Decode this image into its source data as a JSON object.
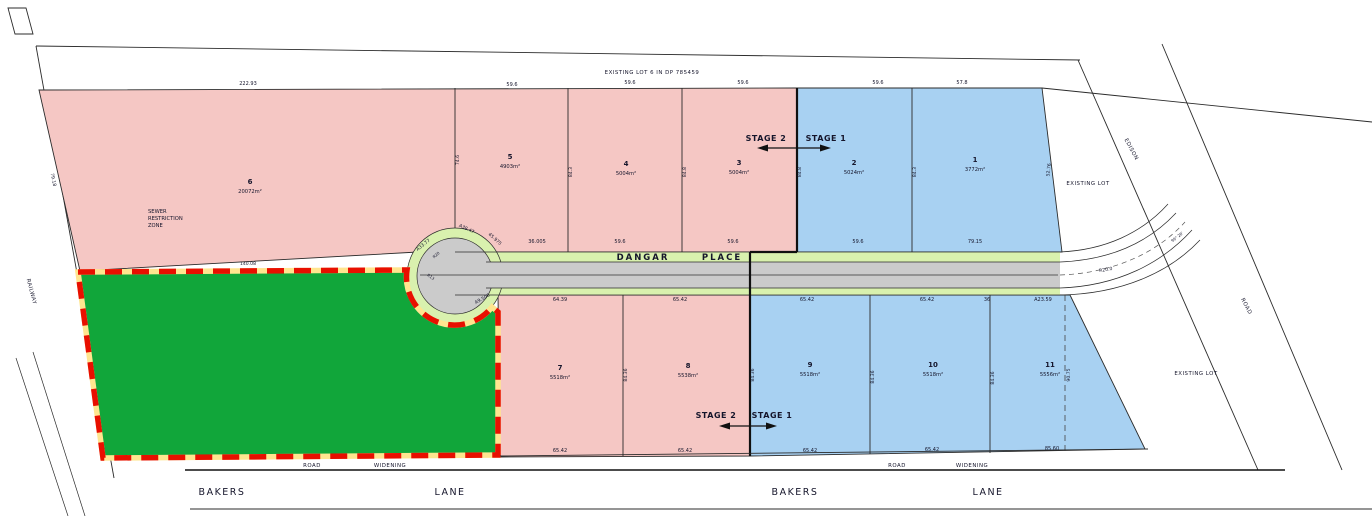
{
  "colors": {
    "pink": "#f5c7c4",
    "blue": "#a8d1f2",
    "green": "#11a63a",
    "verge": "#d9f1ae",
    "pavement": "#cbcbcb",
    "dash_red": "#e80f00",
    "dash_under": "#ffe58f"
  },
  "header": {
    "existing_lot_ref": "EXISTING LOT 6 IN DP 785459"
  },
  "corridors": {
    "railway": "RAILWAY",
    "edison": "EDISON",
    "edison_road": "ROAD",
    "dangar": "DANGAR",
    "place": "PLACE",
    "bakers_west": "BAKERS",
    "lane_west": "LANE",
    "bakers_east": "BAKERS",
    "lane_east": "LANE",
    "road_west": "ROAD",
    "widening_west": "WIDENING",
    "road_east": "ROAD",
    "widening_east": "WIDENING"
  },
  "stages": {
    "stage1": "STAGE 1",
    "stage2": "STAGE 2"
  },
  "zones": {
    "sewer_line1": "SEWER",
    "sewer_line2": "RESTRICTION",
    "sewer_line3": "ZONE",
    "existing_lot_ne": "EXISTING LOT",
    "existing_lot_se": "EXISTING LOT"
  },
  "lots": {
    "1": {
      "num": "1",
      "area": "3772m²"
    },
    "2": {
      "num": "2",
      "area": "5024m²"
    },
    "3": {
      "num": "3",
      "area": "5004m²"
    },
    "4": {
      "num": "4",
      "area": "5004m²"
    },
    "5": {
      "num": "5",
      "area": "4903m²"
    },
    "6": {
      "num": "6",
      "area": "20072m²"
    },
    "7": {
      "num": "7",
      "area": "5518m²"
    },
    "8": {
      "num": "8",
      "area": "5538m²"
    },
    "9": {
      "num": "9",
      "area": "5518m²"
    },
    "10": {
      "num": "10",
      "area": "5518m²"
    },
    "11": {
      "num": "11",
      "area": "5556m²"
    }
  },
  "dims": {
    "top": [
      "222.93",
      "59.6",
      "59.6",
      "59.6",
      "59.6",
      "57.8"
    ],
    "mid": [
      "36.005",
      "59.6",
      "59.6",
      "59.6",
      "79.15"
    ],
    "below_road": [
      "64.39",
      "65.42",
      "65.42",
      "65.42",
      "36",
      "A23.59"
    ],
    "bottom": [
      "65.42",
      "65.42",
      "65.42",
      "65.42",
      "85.60"
    ],
    "sides_top": [
      "79.18",
      "74.6",
      "84.3",
      "84.8",
      "84.8",
      "84.3",
      "52.76"
    ],
    "sides_bottom": [
      "84.36",
      "84.36",
      "84.36",
      "84.36",
      "90.75"
    ],
    "culdesac": [
      "A33.77",
      "A38.47",
      "45.975",
      "A9.506",
      "R20",
      "R13"
    ],
    "green_top": "140.08",
    "junction": [
      "R20.0",
      "99° 28'"
    ]
  }
}
